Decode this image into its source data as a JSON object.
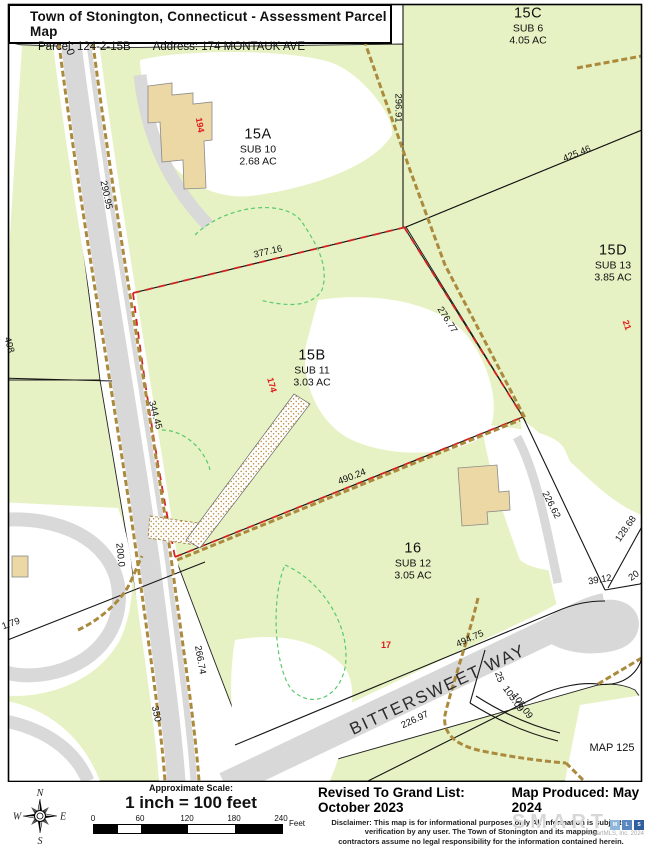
{
  "header": {
    "title": "Town of Stonington, Connecticut - Assessment Parcel Map",
    "parcel": "Parcel: 124-2-15B",
    "address": "Address: 174 MONTAUK AVE"
  },
  "map": {
    "parcels": [
      {
        "id": "15A",
        "sub": "SUB 10",
        "acres": "2.68 AC",
        "x": 258,
        "y": 147
      },
      {
        "id": "15B",
        "sub": "SUB 11",
        "acres": "3.03 AC",
        "x": 312,
        "y": 368
      },
      {
        "id": "15C",
        "sub": "SUB 6",
        "acres": "4.05 AC",
        "x": 528,
        "y": 26
      },
      {
        "id": "15D",
        "sub": "SUB 13",
        "acres": "3.85 AC",
        "x": 613,
        "y": 263
      },
      {
        "id": "16",
        "sub": "SUB 12",
        "acres": "3.05 AC",
        "x": 413,
        "y": 561
      }
    ],
    "dimensions": [
      {
        "t": "290.95",
        "x": 106,
        "y": 195,
        "r": 78
      },
      {
        "t": "408",
        "x": 9,
        "y": 345,
        "r": 75
      },
      {
        "t": "344.45",
        "x": 155,
        "y": 415,
        "r": 75
      },
      {
        "t": "200.0",
        "x": 120,
        "y": 555,
        "r": 84
      },
      {
        "t": "266.74",
        "x": 200,
        "y": 660,
        "r": 80
      },
      {
        "t": "350",
        "x": 156,
        "y": 714,
        "r": 78
      },
      {
        "t": "1.79",
        "x": 11,
        "y": 624,
        "r": -20
      },
      {
        "t": "377.16",
        "x": 268,
        "y": 252,
        "r": -13
      },
      {
        "t": "296.91",
        "x": 398,
        "y": 108,
        "r": 90
      },
      {
        "t": "425.46",
        "x": 577,
        "y": 154,
        "r": -22
      },
      {
        "t": "276.77",
        "x": 447,
        "y": 320,
        "r": 58
      },
      {
        "t": "490.24",
        "x": 352,
        "y": 477,
        "r": -21
      },
      {
        "t": "226.62",
        "x": 551,
        "y": 505,
        "r": 63
      },
      {
        "t": "128.68",
        "x": 626,
        "y": 529,
        "r": -55
      },
      {
        "t": "39.12",
        "x": 600,
        "y": 580,
        "r": -10
      },
      {
        "t": "20",
        "x": 634,
        "y": 576,
        "r": -35
      },
      {
        "t": "494.75",
        "x": 470,
        "y": 639,
        "r": -24
      },
      {
        "t": "25",
        "x": 499,
        "y": 677,
        "r": 70
      },
      {
        "t": "105.09",
        "x": 513,
        "y": 699,
        "r": 55
      },
      {
        "t": "105.09",
        "x": 522,
        "y": 706,
        "r": 55
      },
      {
        "t": "226.97",
        "x": 415,
        "y": 720,
        "r": -25
      }
    ],
    "house_numbers": [
      {
        "t": "194",
        "x": 200,
        "y": 125,
        "r": 80
      },
      {
        "t": "174",
        "x": 272,
        "y": 385,
        "r": 75
      },
      {
        "t": "21",
        "x": 627,
        "y": 325,
        "r": 70
      },
      {
        "t": "17",
        "x": 386,
        "y": 645,
        "r": 0
      }
    ],
    "road_names": [
      {
        "t": "BITTERSWEET WAY",
        "x": 438,
        "y": 690,
        "r": -25,
        "s": 17
      }
    ],
    "notes": [
      {
        "t": "MAP 125",
        "x": 612,
        "y": 748,
        "r": 0,
        "s": 11
      },
      {
        "t": "0",
        "x": 70,
        "y": 52,
        "r": 75
      }
    ]
  },
  "footer": {
    "scale_heading": "Approximate Scale:",
    "scale_text": "1 inch = 100 feet",
    "scale_ticks": [
      "0",
      "60",
      "120",
      "180",
      "240"
    ],
    "scale_unit": "Feet",
    "revised": "Revised To Grand List: October 2023",
    "produced": "Map Produced: May 2024",
    "disclaimer_lines": [
      "Disclaimer: This map is for informational purposes only All information is subject to",
      "verification by any user. The Town of Stonington and its mapping",
      "contractors assume no legal responsibility for the information contained herein."
    ],
    "logo_text": "SMART",
    "logo_squares": [
      "M",
      "L",
      "S"
    ],
    "logo_square_colors": [
      "#8fb7dc",
      "#5b87c0",
      "#2e5f9e"
    ],
    "copyright": "© SmartMLS, Inc.  2024",
    "compass": [
      "N",
      "E",
      "S",
      "W"
    ]
  },
  "colors": {
    "parcel_green": "#e6f2c3",
    "road_gray": "#d8d8d8",
    "wall_tan": "#ab8a3e",
    "selected_boundary_red": "#d42222",
    "house_number_red": "#e01b1b",
    "contour_green": "#58c96c",
    "building_tan": "#ecd8a4"
  }
}
